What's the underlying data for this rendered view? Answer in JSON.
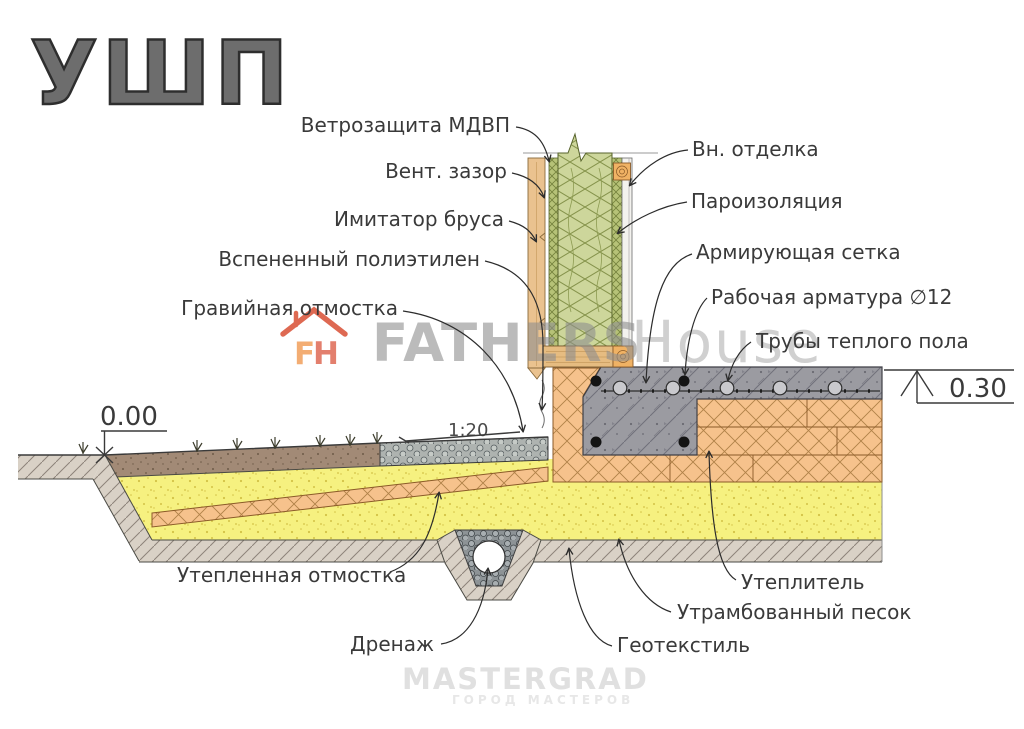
{
  "title": "УШП",
  "labels": {
    "wind_protection": "Ветрозащита МДВП",
    "vent_gap": "Вент. зазор",
    "timber_imitation": "Имитатор бруса",
    "foamed_polyethylene": "Вспененный полиэтилен",
    "gravel_apron": "Гравийная отмостка",
    "interior_finish": "Вн. отделка",
    "vapor_barrier": "Пароизоляция",
    "reinforcing_mesh": "Армирующая сетка",
    "working_rebar": "Рабочая арматура ∅12",
    "heating_pipes": "Трубы теплого пола",
    "insulated_apron": "Утепленная отмостка",
    "drainage": "Дренаж",
    "geotextile": "Геотекстиль",
    "insulation": "Утеплитель",
    "compacted_sand": "Утрамбованный песок"
  },
  "marks": {
    "ground_level": "0.00",
    "floor_level": "0.30",
    "slope": "1:20"
  },
  "watermarks": {
    "logo_monogram_left": "F",
    "logo_monogram_right": "H",
    "center_bold": "FATHERS",
    "center_light": "House",
    "bottom_main": "MASTERGRAD",
    "bottom_sub": "ГОРОД МАСТЕРОВ"
  },
  "colors": {
    "concrete": "#9b9ba1",
    "insulation_orange": "#f6c28c",
    "wall_insulation_green": "#cdd69b",
    "membrane_green": "#b6c277",
    "sand": "#f6f180",
    "topsoil": "#a28a76",
    "soil_band": "#d9d1c6",
    "gravel": "#aeb3b0",
    "wood": "#eac28f",
    "label_ink": "#3a3a3a",
    "watermark_red": "#d94f35"
  }
}
